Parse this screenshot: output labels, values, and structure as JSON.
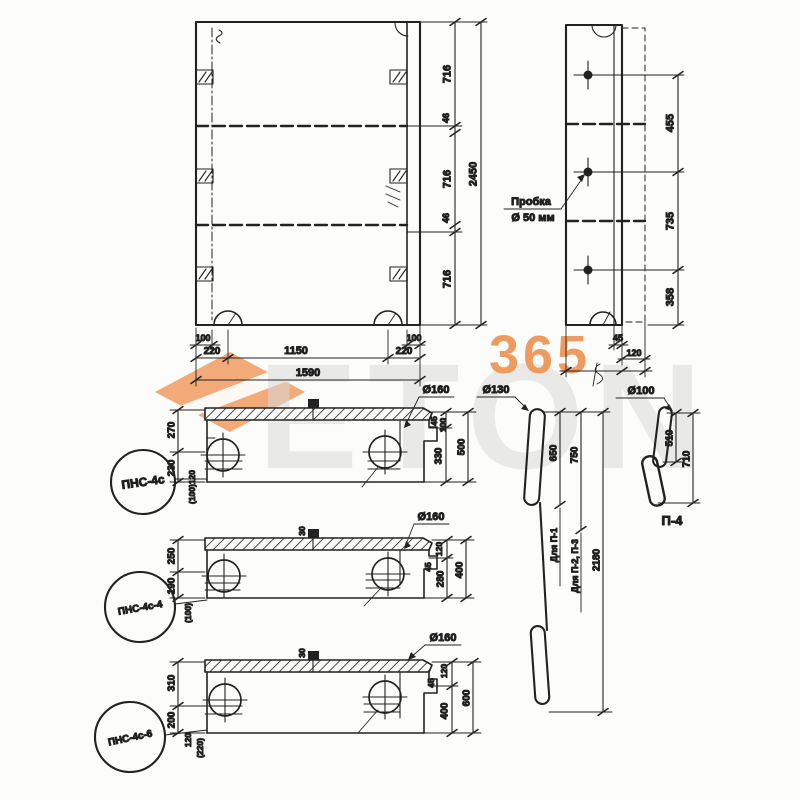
{
  "watermark": {
    "brand": "ETON",
    "number": "365",
    "orange": "#ee9b60",
    "gray": "#dadad8"
  },
  "plan_view": {
    "seg_dims": [
      "716",
      "46",
      "716",
      "46",
      "716"
    ],
    "overall_height": "2450",
    "edge_dims": [
      "100",
      "100"
    ],
    "bottom_dims": [
      "220",
      "1150",
      "220"
    ],
    "overall_width": "1590"
  },
  "side_view": {
    "plug_note_line1": "Пробка",
    "plug_note_line2": "Ø 50 мм",
    "hole_dims": [
      "455",
      "735",
      "358"
    ],
    "edge_dim": "45",
    "thickness_dim": "120"
  },
  "sections": [
    {
      "tag": "ПНС-4с",
      "dia": "Ø160",
      "left_dims": [
        "270",
        "230"
      ],
      "left_note": "(100)120",
      "small_dims": [
        "45",
        "100"
      ],
      "mid_dim": "330",
      "overall_dim": "500"
    },
    {
      "tag": "ПНС-4с-4",
      "dia": "Ø160",
      "stub_dim": "30",
      "left_dims": [
        "250",
        "190"
      ],
      "left_note": "(100)",
      "small_dims": [
        "120",
        "45"
      ],
      "mid_dim": "280",
      "overall_dim": "400"
    },
    {
      "tag": "ПНС-4с-6",
      "dia": "Ø160",
      "stub_dim": "30",
      "left_dims": [
        "310",
        "200"
      ],
      "left_note": "120",
      "left_note2": "(220)",
      "small_dims": [
        "120",
        "45"
      ],
      "mid_dim": "400",
      "overall_dim": "600"
    }
  ],
  "loops": {
    "rod_dia": "Ø130",
    "rod_dims": [
      "650",
      "750",
      "2180"
    ],
    "rod_usage": [
      "Для П-1",
      "Для П-2, П-3"
    ],
    "hook_tag": "П-4",
    "hook_dia": "Ø100",
    "hook_dims": [
      "510",
      "710"
    ]
  }
}
